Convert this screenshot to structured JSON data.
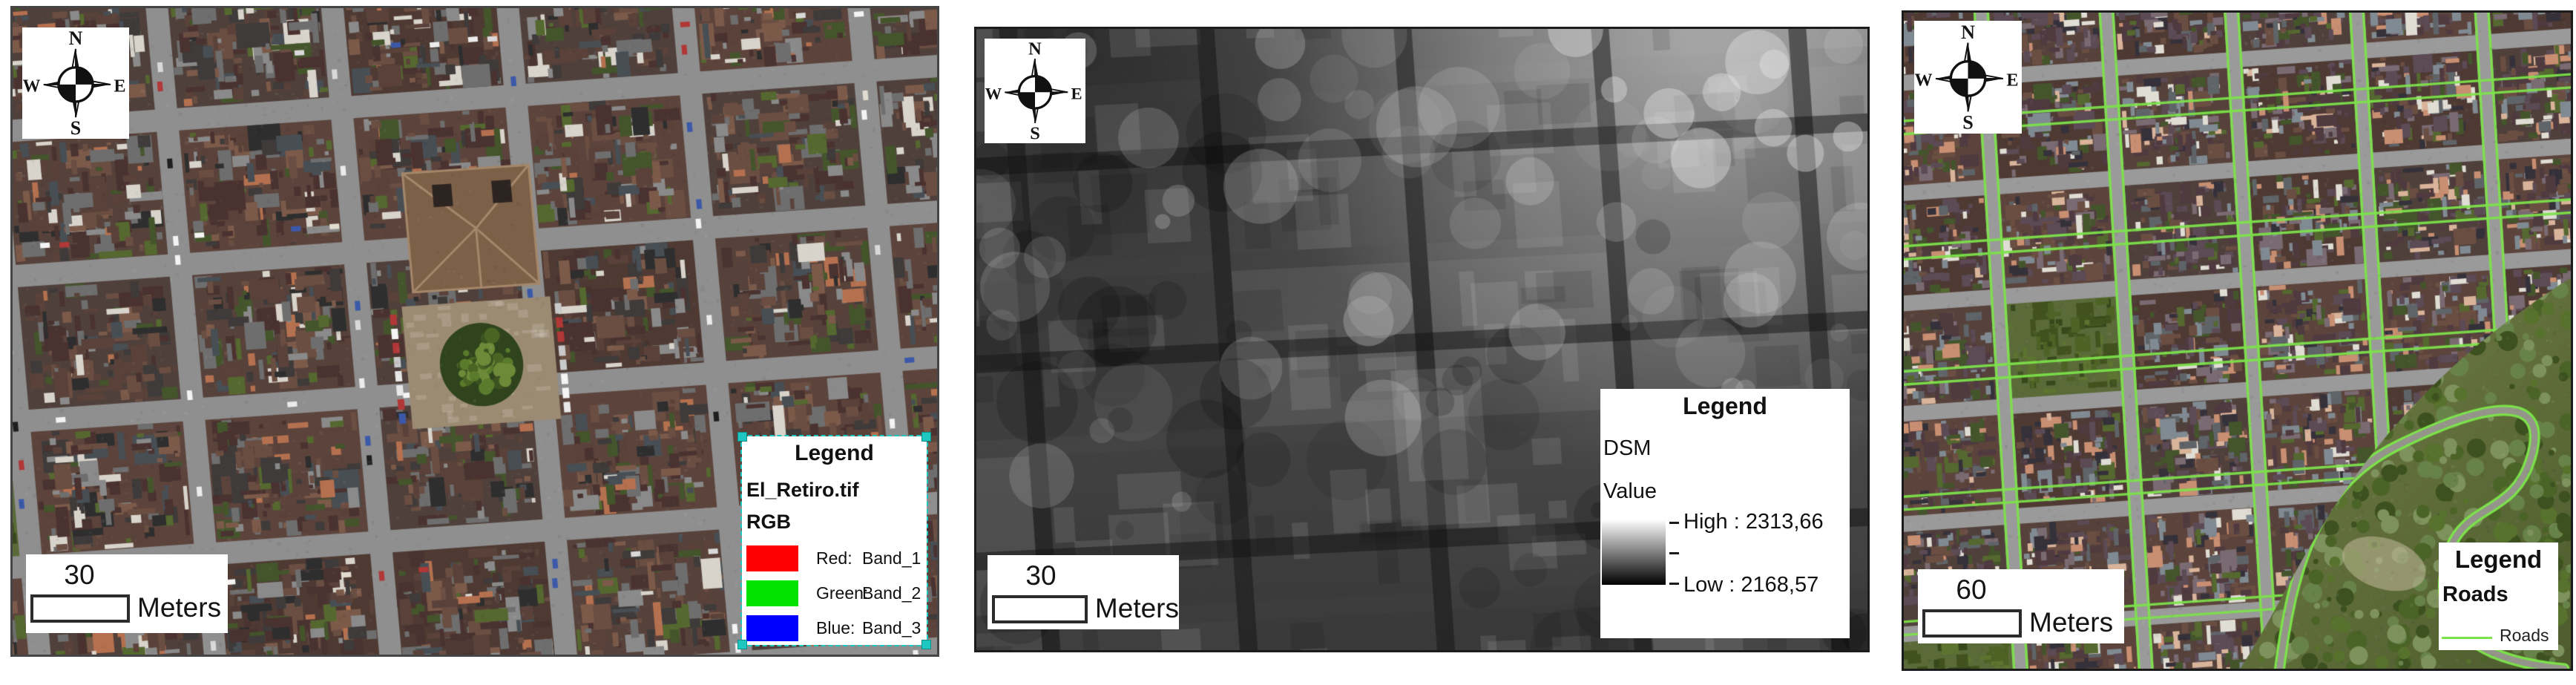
{
  "panels": [
    {
      "name": "orthophoto",
      "compass": {
        "n": "N",
        "e": "E",
        "s": "S",
        "w": "W"
      },
      "scale_bar": {
        "value": "30",
        "unit": "Meters"
      },
      "legend": {
        "title": "Legend",
        "layer_name": "El_Retiro.tif",
        "layer_type": "RGB",
        "selected": true,
        "items": [
          {
            "channel": "Red:",
            "band": "Band_1",
            "color": "#ff0000"
          },
          {
            "channel": "Green:",
            "band": "Band_2",
            "color": "#00e400"
          },
          {
            "channel": "Blue:",
            "band": "Band_3",
            "color": "#0000ff"
          }
        ]
      }
    },
    {
      "name": "dsm",
      "compass": {
        "n": "N",
        "e": "E",
        "s": "S",
        "w": "W"
      },
      "scale_bar": {
        "value": "30",
        "unit": "Meters"
      },
      "legend": {
        "title": "Legend",
        "layer_name": "DSM",
        "value_label": "Value",
        "high_label": "High : 2313,66",
        "low_label": "Low : 2168,57",
        "ramp_top": "#ffffff",
        "ramp_bottom": "#000000"
      }
    },
    {
      "name": "roads",
      "compass": {
        "n": "N",
        "e": "E",
        "s": "S",
        "w": "W"
      },
      "scale_bar": {
        "value": "60",
        "unit": "Meters"
      },
      "legend": {
        "title": "Legend",
        "layer_name": "Roads",
        "items": [
          {
            "label": "Roads",
            "color": "#7ce24a",
            "symbol": "line"
          }
        ]
      }
    }
  ]
}
